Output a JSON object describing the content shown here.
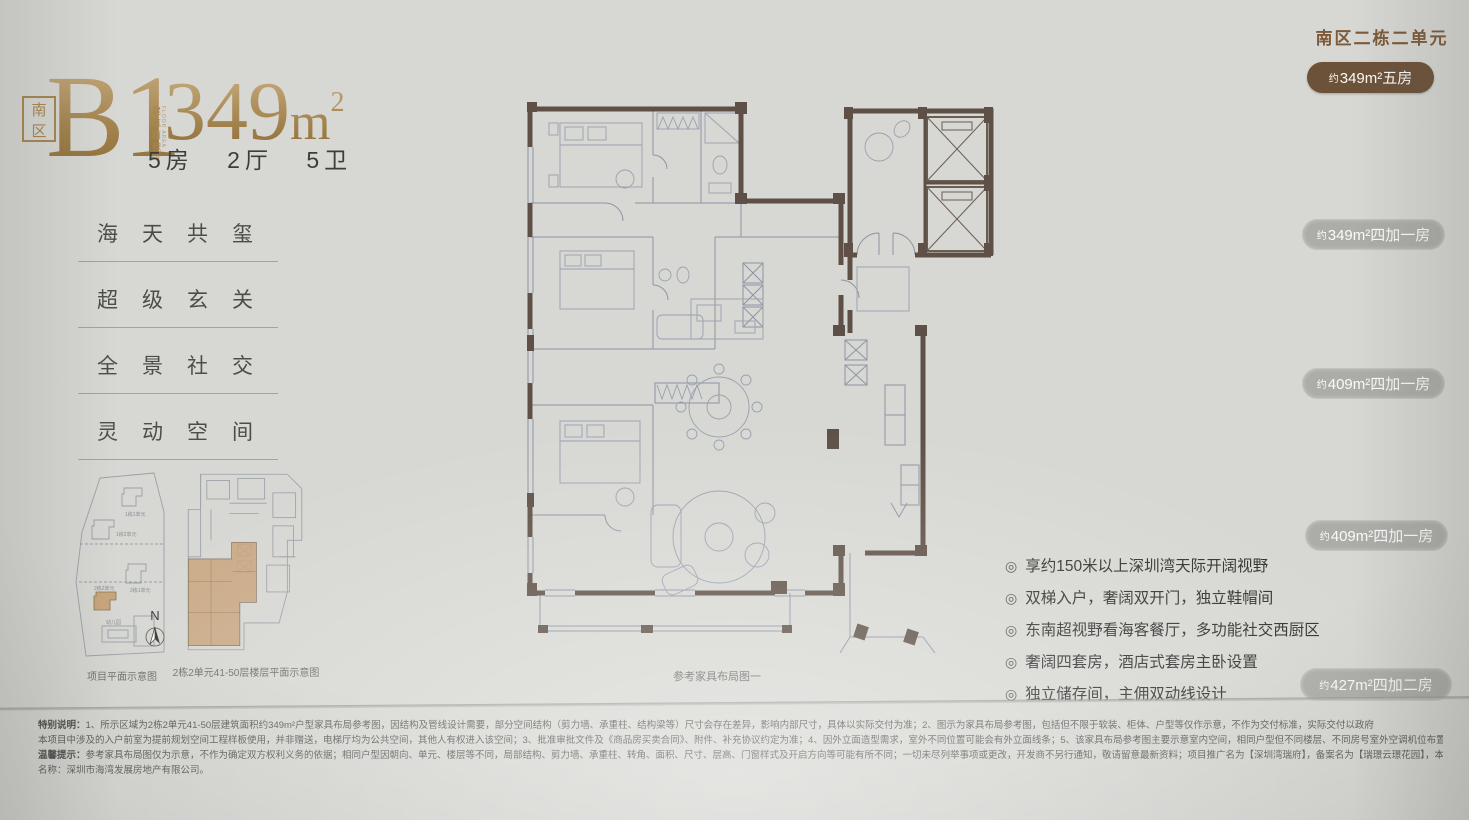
{
  "header": {
    "zone_badge": "南区",
    "unit_code": "B1",
    "area_label_cn": "建筑面积",
    "area_label_en": "FLOOR AREA",
    "area_approx": "约",
    "area_value": "349",
    "area_unit": "m",
    "area_unit_sup": "2",
    "spec": "5房 2厅 5卫"
  },
  "features": [
    "海天共玺",
    "超级玄关",
    "全景社交",
    "灵动空间"
  ],
  "mini_maps": {
    "site_caption": "项目平面示意图",
    "floor_caption": "2栋2单元41-50层楼层平面示意图",
    "compass_label": "N",
    "site_labels": {
      "b11": "1栋1单元",
      "b12": "1栋2单元",
      "b21": "2栋1单元",
      "b22": "2栋2单元",
      "kg": "幼儿园"
    }
  },
  "plan_caption": "参考家具布局图一",
  "right_panel": {
    "title": "南区二栋二单元",
    "badges": [
      {
        "prefix": "约",
        "label": "349m²五房"
      },
      {
        "prefix": "约",
        "label": "349m²四加一房"
      },
      {
        "prefix": "约",
        "label": "409m²四加一房"
      },
      {
        "prefix": "约",
        "label": "409m²四加一房"
      },
      {
        "prefix": "约",
        "label": "427m²四加二房"
      }
    ]
  },
  "bullet_icon": "◎",
  "selling_points": [
    "享约150米以上深圳湾天际开阔视野",
    "双梯入户，奢阔双开门，独立鞋帽间",
    "东南超视野看海客餐厅，多功能社交西厨区",
    "奢阔四套房，酒店式套房主卧设置",
    "独立储存间，主佣双动线设计"
  ],
  "disclaimer": {
    "lines": [
      {
        "bold": "特别说明：",
        "text": "1、所示区域为2栋2单元41-50层建筑面积约349m²户型家具布局参考图，因结构及管线设计需要，部分空间结构（剪力墙、承重柱、结构梁等）尺寸会存在差异，影响内部尺寸，具体以实际交付为准；2、图示为家具布局参考图，包括但不限于软装、柜体、户型等仅作示意，不作为交付标准，实际交付以政府"
      },
      {
        "bold": "",
        "text": "本项目中涉及的入户前室为提前规划空间工程样板使用，并非赠送，电梯厅均为公共空间，其他人有权进入该空间；3、批准审批文件及《商品房买卖合同》、附件、补充协议约定为准；4、因外立面造型需求，室外不同位置可能会有外立面线条；5、该家具布局参考图主要示意室内空间，相同户型但不同楼层、不同房号室外空调机位布置有差异，具体以合同文件为准。"
      },
      {
        "bold": "温馨提示：",
        "text": "参考家具布局图仅为示意，不作为确定双方权利义务的依据；相同户型因朝向、单元、楼层等不同，局部结构、剪力墙、承重柱、转角、面积、尺寸、层高、门窗样式及开启方向等可能有所不同；一切未尽列举事项或更改，开发商不另行通知，敬请留意最新资料；项目推广名为【深圳湾瑞府】，备案名为【瑞璟云璟花园】，本宣传资料时间为2025年11月，开发商"
      },
      {
        "bold": "",
        "text": "名称：深圳市海湾发展房地产有限公司。"
      }
    ]
  },
  "colors": {
    "gold": "#a5854f",
    "title_brown": "#7d5a3a",
    "badge_dark": "#6d523a",
    "badge_muted": "#acaca8",
    "wall": "#5e5046",
    "plan_line": "#8d95a4",
    "unit_highlight": "#c9a57c",
    "background": "#d7d7d3"
  }
}
